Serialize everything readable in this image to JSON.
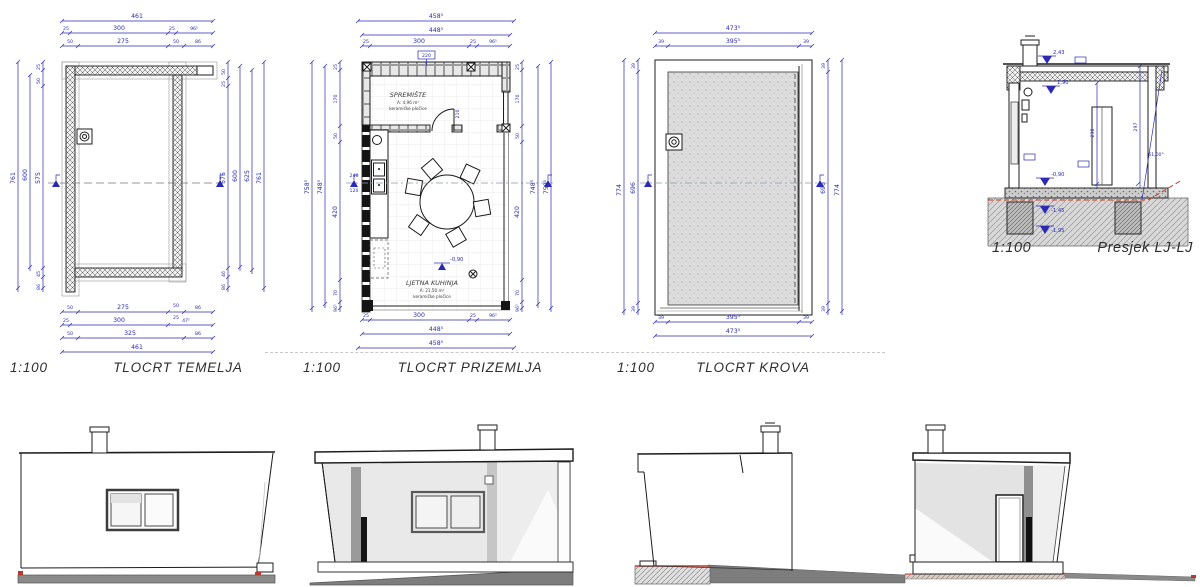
{
  "colors": {
    "dimension_blue": "#2a2ab4",
    "line_black": "#1c1c1c",
    "roof_gray": "#dcdcdc",
    "ground_dark_gray": "#7d7d7d",
    "terrain_red": "#c03a2b"
  },
  "plans": {
    "temelja": {
      "scale": "1:100",
      "title": "TLOCRT TEMELJA",
      "top": [
        "461",
        "25",
        "300",
        "25",
        "96⁵",
        "50",
        "275",
        "50",
        "86"
      ],
      "bottom": [
        "50",
        "275",
        "50",
        "25",
        "86",
        "25",
        "300",
        "47⁵",
        "50",
        "325",
        "86",
        "461"
      ],
      "left": [
        "761",
        "600",
        "25",
        "50",
        "575",
        "45",
        "86"
      ],
      "right": [
        "50",
        "25",
        "575",
        "600",
        "625",
        "761",
        "46",
        "86"
      ]
    },
    "prizemlja": {
      "scale": "1:100",
      "title": "TLOCRT PRIZEMLJA",
      "top": [
        "458⁵",
        "448⁵",
        "25",
        "300",
        "25",
        "96⁵"
      ],
      "wall_tag": "220",
      "bottom": [
        "25",
        "300",
        "25",
        "96⁵",
        "448⁵",
        "458⁵"
      ],
      "left": [
        "758⁵",
        "748⁵",
        "25",
        "170",
        "50",
        "420",
        "70",
        "96⁵"
      ],
      "parapet": [
        "240",
        "120"
      ],
      "right": [
        "25",
        "170",
        "50",
        "420",
        "70",
        "96⁵",
        "748⁵",
        "758⁵"
      ],
      "door_height": "210",
      "floor_level": "-0,90",
      "rooms": {
        "spremiste": {
          "name": "SPREMIŠTE",
          "area": "A: 4,96 m²",
          "floor": "keramičke pločice"
        },
        "kuhinja": {
          "name": "LJETNA KUHINJA",
          "area": "A: 21,50 m²",
          "floor": "keramičke pločice"
        }
      }
    },
    "krova": {
      "scale": "1:100",
      "title": "TLOCRT KROVA",
      "top": [
        "473⁵",
        "39",
        "395⁵",
        "39"
      ],
      "bottom": [
        "39",
        "395⁵",
        "39",
        "473⁵"
      ],
      "left": [
        "774",
        "39",
        "696",
        "39"
      ],
      "right": [
        "39",
        "696",
        "39",
        "774"
      ]
    },
    "presjek": {
      "scale": "1:100",
      "title": "Presjek LJ-LJ",
      "levels": [
        "2,43",
        "1,90",
        "-0,90",
        "-1,45",
        "-1,95"
      ],
      "dims": [
        "230",
        "297"
      ],
      "angle": "61,00°"
    }
  }
}
